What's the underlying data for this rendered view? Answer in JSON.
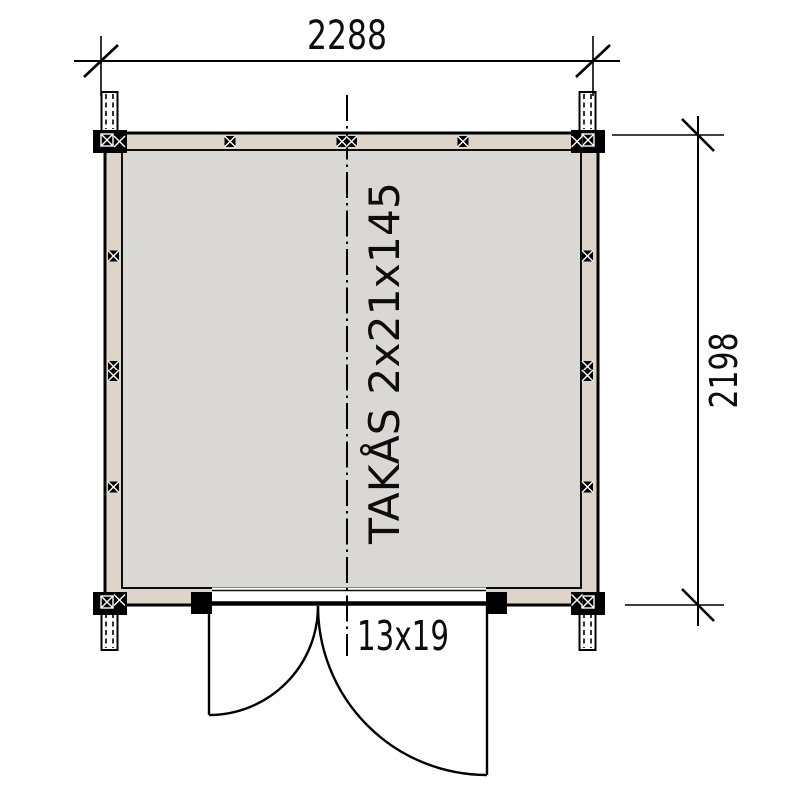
{
  "drawing": {
    "type": "floor-plan",
    "width_dim": "2288",
    "height_dim": "2198",
    "ridge_label": "TAKÅS 2x21x145",
    "door_label": "13x19",
    "colors": {
      "background": "#ffffff",
      "wall_fill": "#ddd5c9",
      "floor_fill": "#d9d8d4",
      "line": "#000000"
    }
  }
}
